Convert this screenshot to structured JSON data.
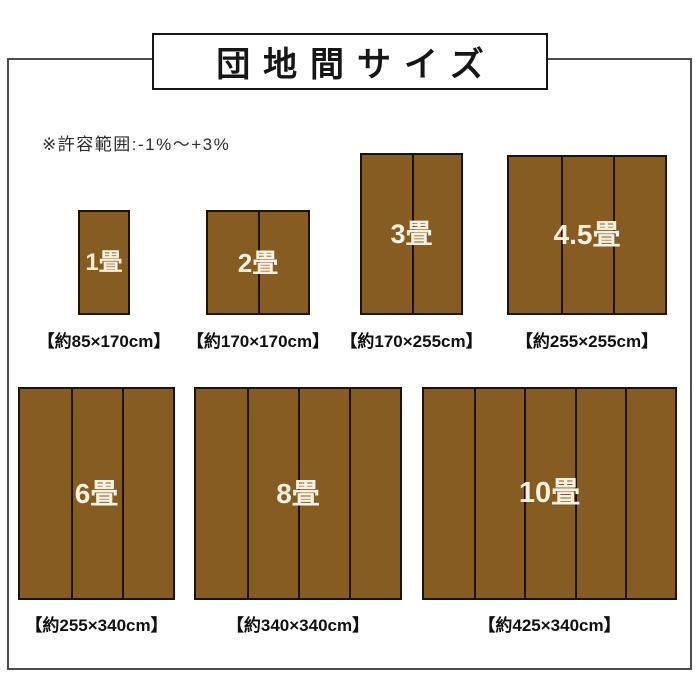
{
  "title_banner": {
    "text": "団地間サイズ"
  },
  "note": {
    "text": "※許容範囲:-1%〜+3%"
  },
  "colors": {
    "mat_fill": "#865C22",
    "mat_border": "#1C1206",
    "panel_divider": "#1C1206",
    "label_text": "#F5F0E0",
    "caption_text": "#111111",
    "frame_border": "#4D4D4D",
    "title_border": "#161616"
  },
  "mats": [
    {
      "label": "1畳",
      "caption": "【約85×170cm】",
      "panels": 1
    },
    {
      "label": "2畳",
      "caption": "【約170×170cm】",
      "panels": 2
    },
    {
      "label": "3畳",
      "caption": "【約170×255cm】",
      "panels": 2
    },
    {
      "label": "4.5畳",
      "caption": "【約255×255cm】",
      "panels": 3
    },
    {
      "label": "6畳",
      "caption": "【約255×340cm】",
      "panels": 3
    },
    {
      "label": "8畳",
      "caption": "【約340×340cm】",
      "panels": 4
    },
    {
      "label": "10畳",
      "caption": "【約425×340cm】",
      "panels": 5
    }
  ]
}
